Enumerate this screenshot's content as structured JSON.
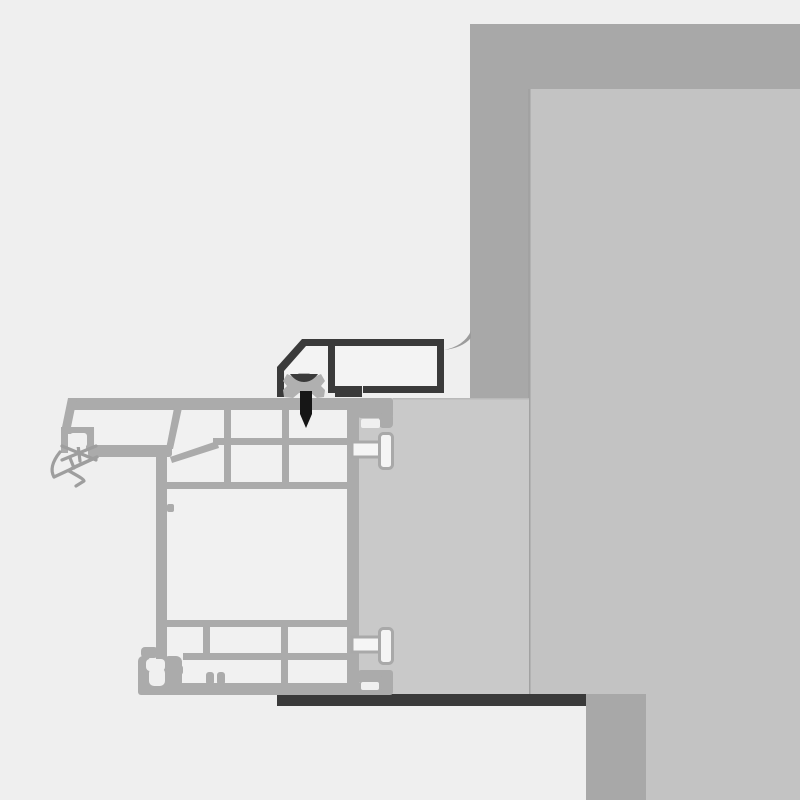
{
  "document": {
    "kind": "technical-cross-section-diagram",
    "subject": "Window frame sill installation detail at masonry wall",
    "visible_text": ""
  },
  "colors": {
    "bg": "#efefef",
    "wall-band": "#a8a8a8",
    "wall-interior": "#c3c3c3",
    "wall-edge": "#a2a2a2",
    "mounting-block": "#c9c9c9",
    "block-edge": "#b9b9b9",
    "profile-gray": "#ababab",
    "cell-white": "#f1f1f1",
    "notch-white": "#f0f0f0",
    "bracket-dark": "#3a3a3a",
    "bracket-fill": "#f3f3f3",
    "sill-strip": "#3a3a3a",
    "screw-black": "#161616",
    "seal-gray": "#b0b0b0",
    "swoosh-gray": "#9c9c9c",
    "gasket-gray": "#9e9e9e",
    "plug-fill": "#f5f5f5",
    "plug-stroke": "#a9a9a9"
  },
  "components": {
    "wall": {
      "label": "masonry wall with interior reveal"
    },
    "block": {
      "label": "mounting / sub-sill block"
    },
    "frame": {
      "label": "multi-chamber window frame profile cross-section"
    },
    "bracket": {
      "label": "dark flashing bracket profile"
    },
    "screw": {
      "label": "fixing screw with sealing washer"
    },
    "seal": {
      "label": "compression seal block"
    },
    "gasket": {
      "label": "exterior flexible gasket lips"
    },
    "plugs": {
      "label": "wall anchor plugs"
    },
    "strip": {
      "label": "dark sill sealing strip"
    },
    "swoosh": {
      "label": "membrane swoosh to wall"
    }
  }
}
